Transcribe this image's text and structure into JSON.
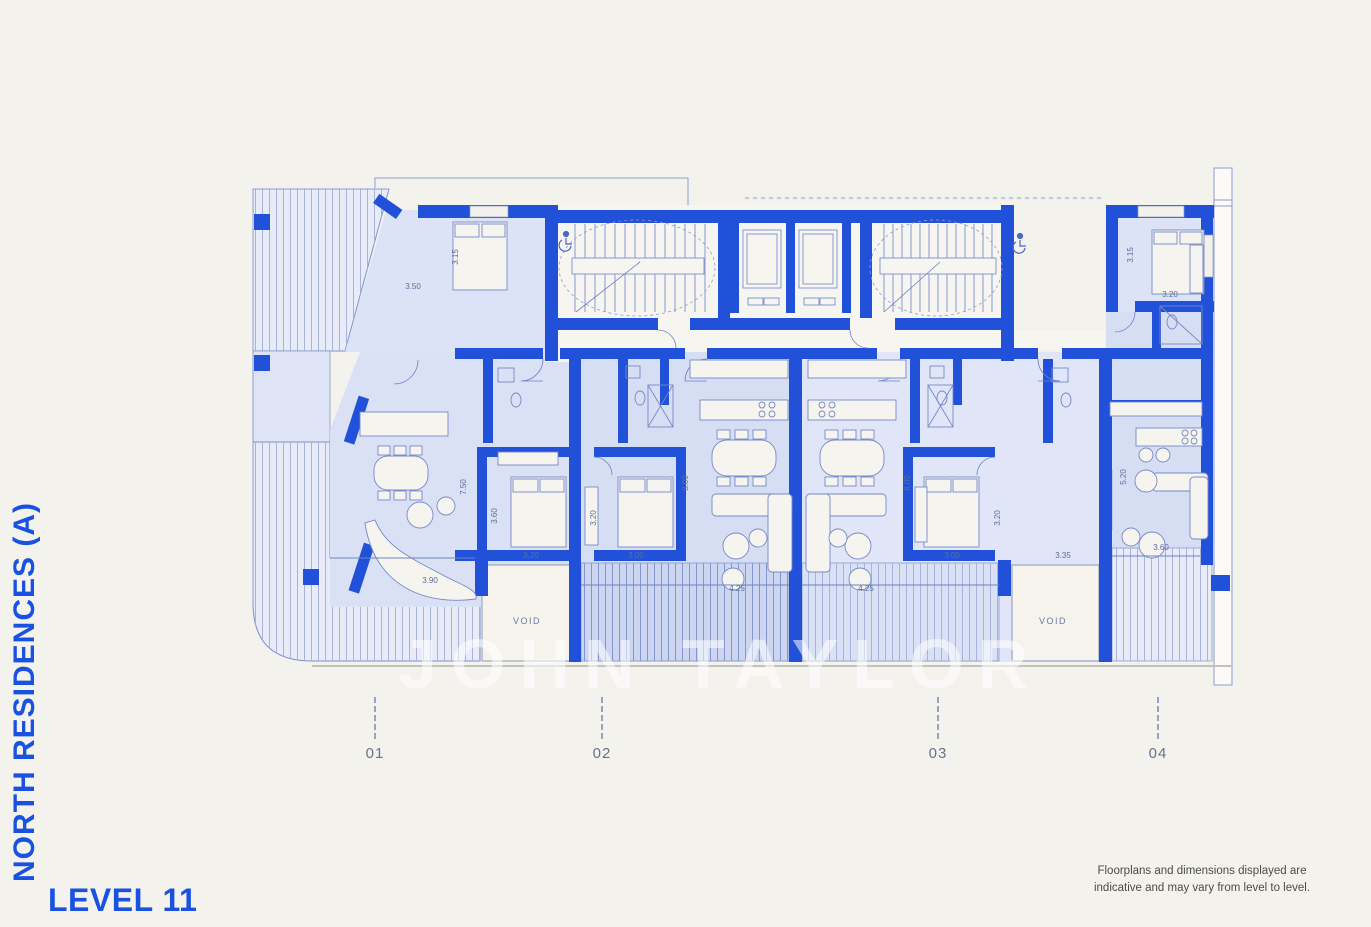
{
  "titles": {
    "side_title": "NORTH RESIDENCES (A)",
    "level_label": "LEVEL 11"
  },
  "disclaimer": {
    "line1": "Floorplans and dimensions displayed are",
    "line2": "indicative and may vary from level to level."
  },
  "watermark": "JOHN TAYLOR",
  "units": [
    {
      "label": "01",
      "x": 375
    },
    {
      "label": "02",
      "x": 602
    },
    {
      "label": "03",
      "x": 938
    },
    {
      "label": "04",
      "x": 1158
    }
  ],
  "plan": {
    "void_labels": [
      {
        "text": "VOID",
        "x": 527,
        "y": 624
      },
      {
        "text": "VOID",
        "x": 1053,
        "y": 624
      }
    ],
    "dimensions": [
      {
        "t": "3.50",
        "x": 413,
        "y": 289,
        "r": 0
      },
      {
        "t": "3.15",
        "x": 458,
        "y": 257,
        "r": 1
      },
      {
        "t": "7.50",
        "x": 466,
        "y": 487,
        "r": 1
      },
      {
        "t": "3.60",
        "x": 497,
        "y": 516,
        "r": 1
      },
      {
        "t": "3.20",
        "x": 531,
        "y": 558,
        "r": 0
      },
      {
        "t": "3.90",
        "x": 430,
        "y": 583,
        "r": 0
      },
      {
        "t": "3.20",
        "x": 596,
        "y": 518,
        "r": 1
      },
      {
        "t": "3.00",
        "x": 636,
        "y": 558,
        "r": 0
      },
      {
        "t": "8.00",
        "x": 688,
        "y": 483,
        "r": 1
      },
      {
        "t": "4.25",
        "x": 737,
        "y": 591,
        "r": 0
      },
      {
        "t": "4.25",
        "x": 866,
        "y": 591,
        "r": 0
      },
      {
        "t": "8.00",
        "x": 910,
        "y": 483,
        "r": 1
      },
      {
        "t": "3.20",
        "x": 1000,
        "y": 518,
        "r": 1
      },
      {
        "t": "3.00",
        "x": 952,
        "y": 558,
        "r": 0
      },
      {
        "t": "3.35",
        "x": 1063,
        "y": 558,
        "r": 0
      },
      {
        "t": "5.20",
        "x": 1126,
        "y": 477,
        "r": 1
      },
      {
        "t": "3.60",
        "x": 1161,
        "y": 550,
        "r": 0
      },
      {
        "t": "3.15",
        "x": 1133,
        "y": 255,
        "r": 1
      },
      {
        "t": "3.20",
        "x": 1170,
        "y": 297,
        "r": 0
      }
    ],
    "colors": {
      "background": "#f4f2ed",
      "wall_blue": "#2151d8",
      "accent_blue": "#1952e1",
      "room_fill": "#dbe1f4",
      "room_fill_dark": "#d6def3",
      "terrace_fill": "#e8ecf8",
      "balcony_fill": "#ccd6f0",
      "hatch_line": "#a8b2da",
      "core_fill": "#f7f5f0",
      "dim_text": "#5d6d9d"
    }
  }
}
